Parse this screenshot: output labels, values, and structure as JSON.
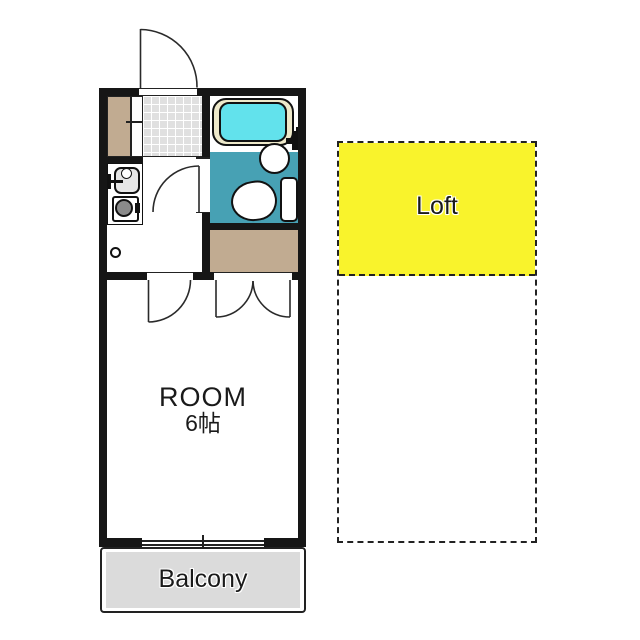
{
  "floor_plan": {
    "room_label": "ROOM",
    "room_area": "6帖",
    "loft_label": "Loft",
    "balcony_label": "Balcony"
  },
  "colors": {
    "wall": "#161616",
    "line": "#2a2a2a",
    "loft_yellow": "#F9F32C",
    "bath_teal": "#47A1B4",
    "tub_cyan": "#62E2EC",
    "tub_rim": "#EEE9CA",
    "closet_tan": "#C1AB91",
    "balcony_gray": "#DBDBDB",
    "tile_gray": "#E0E0E0",
    "burner_gray": "#8A8A8A",
    "sink_gray": "#E6E6E6"
  },
  "fixtures": [
    "bathtub",
    "wash-basin",
    "toilet",
    "shower-mixer",
    "kitchen-sink",
    "kitchen-faucet",
    "stove-burner",
    "floor-drain"
  ]
}
